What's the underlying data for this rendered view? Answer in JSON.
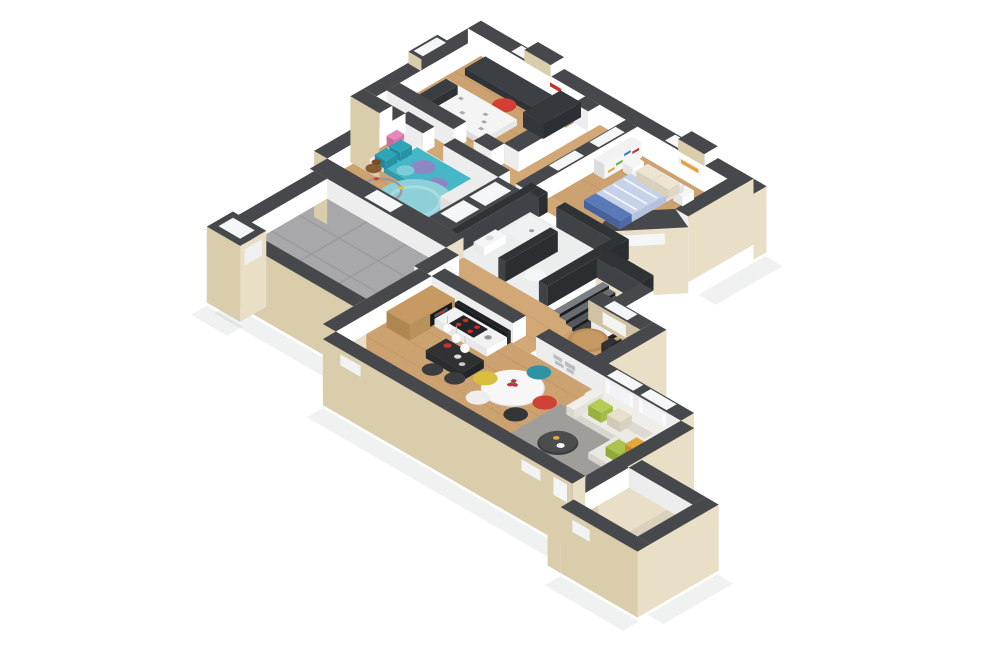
{
  "scene": {
    "title": "3D isometric floor plan rendering of a single-storey home",
    "type": "architectural 3D floor plan",
    "background": "#ffffff"
  },
  "palette": {
    "wall_top": "#46484b",
    "wall_top_dark": "#303336",
    "dark_wall_face": "#2b2e31",
    "dark_wall_face2": "#3f4246",
    "ext_light": "#e9dfc7",
    "ext_dark": "#d9cdac",
    "int_white": "#ffffff",
    "int_white_shade": "#ededee",
    "tan_wall": "#cfc3a3",
    "shadow": "#30343a",
    "window_white": "#f5f6f7"
  },
  "rooms": [
    {
      "id": "teen-bedroom",
      "label": "Teen bedroom",
      "floor": "#cda271"
    },
    {
      "id": "kids-bedroom",
      "label": "Kids bedroom",
      "floor": "#cda271"
    },
    {
      "id": "master-bedroom",
      "label": "Master bedroom",
      "floor": "#cda271"
    },
    {
      "id": "hallway",
      "label": "Hallway",
      "floor": "#d2a877"
    },
    {
      "id": "bathroom",
      "label": "Bathroom",
      "floor": "#eceded"
    },
    {
      "id": "staircase",
      "label": "Staircase",
      "floor": "#2a2d30"
    },
    {
      "id": "office-nook",
      "label": "Home office nook",
      "floor": "#cda271"
    },
    {
      "id": "garage",
      "label": "Garage",
      "floor": "#a8a8aa"
    },
    {
      "id": "living-room",
      "label": "Open living / kitchen / dining",
      "floor": "#cda271"
    },
    {
      "id": "entry",
      "label": "Entry room",
      "floor": "#dad1bc"
    }
  ],
  "furniture": {
    "teen": {
      "desk": "#3c3f43",
      "desk_side": "#2f3236",
      "stool": "#d24034",
      "bed": "#f4f4f4",
      "doodle": "#8a8a8a",
      "pillow": "#3a3d41",
      "wardrobe": "#35383c",
      "frame": "#ffffff",
      "frame_accent": "#c2332b"
    },
    "kids": {
      "bed_base": "#f6f6f6",
      "duvet": "#45b7c7",
      "duvet_circle": "#9a7fc6",
      "duvet_circle2": "#7fd0da",
      "pillow": "#2ea4b8",
      "rug": "#8fd0d8",
      "rug_ring": "#a5dde3",
      "teddy": "#8a5a33",
      "track": "#9a9a9a",
      "toy1": "#d0453a",
      "toy2": "#3d7fc4",
      "toy3": "#63b247",
      "toy4": "#e0c23c",
      "shelf_toy": "#e589b8"
    },
    "master": {
      "bed_base": "#eef0f4",
      "duvet": "#c5d2ea",
      "stripe": "#ffffff",
      "pillow": "#ece5d2",
      "throw": "#5b79b8",
      "nightstand": "#f6f6f6",
      "shelf": "#f2f2f2",
      "book1": "#c2332b",
      "book2": "#3d7fc4",
      "book3": "#63b247",
      "book4": "#e0a63c",
      "picture": "#e0a63c"
    },
    "bathroom": {
      "fixture": "#f4f5f6",
      "tray": "#eff1f2",
      "drain": "#9a9a9a"
    },
    "office": {
      "table": "#bb8e58",
      "chair": "#303234",
      "radiator": "#fafafa"
    },
    "kitchen": {
      "wood": "#c89a63",
      "wood_side": "#b9915a",
      "unit_front": "#18191b",
      "counter_top": "#f2f2f3",
      "counter_face": "#ffffff",
      "hob": "#232528",
      "burner": "#d03028",
      "splash": "#202225",
      "island": "#2f3133",
      "island_face": "#222426",
      "stool": "#3a3c3e",
      "pendant": "#ffffff",
      "kettle": "#c23333"
    },
    "dining": {
      "table": "#f7f7f7",
      "table_side": "#e4e4e4",
      "chair_teal": "#2f93a8",
      "chair_red": "#cf4336",
      "chair_yellow": "#d8bf3e",
      "chair_white": "#eeeeee",
      "chair_black": "#333537",
      "flowers": "#c4304a",
      "stems": "#5d8f46"
    },
    "living": {
      "sofa": "#eceae4",
      "sofa_back": "#f0eee8",
      "sofa_side": "#e2e0d9",
      "sofa_side2": "#d8d6cf",
      "chaise": "#eae8e2",
      "cushion_green": "#b5cd57",
      "cushion_lime": "#aac44e",
      "cushion_beige": "#e6e0cc",
      "cushion_orange": "#e3a73d",
      "rug": "#9c9e9c",
      "coffee_table": "#4a4c4e",
      "coffee_side": "#3c3e40",
      "deco": "#b9bcbe",
      "curtain": "#fbfbfb"
    }
  }
}
